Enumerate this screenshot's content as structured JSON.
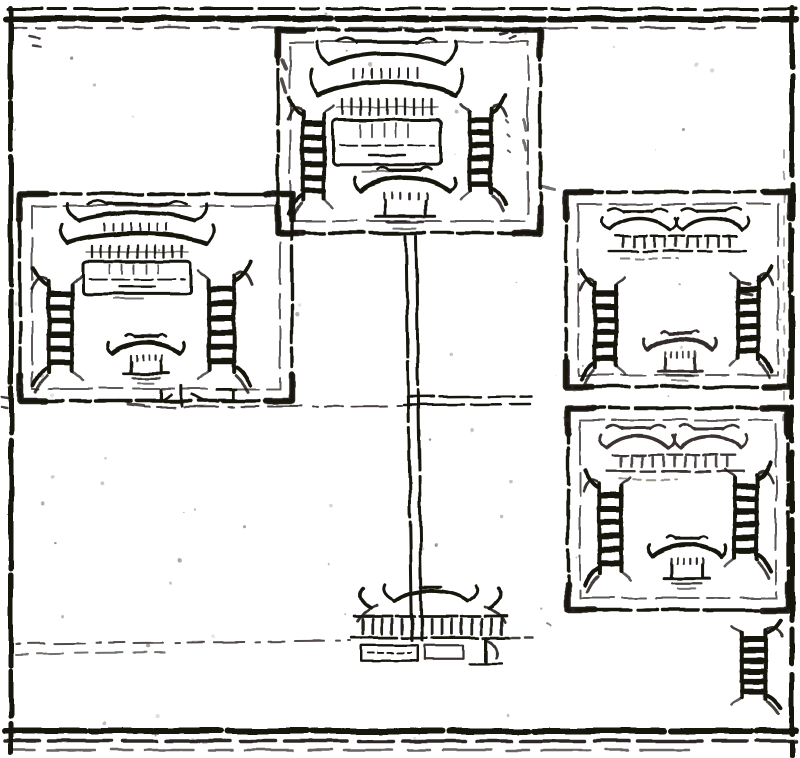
{
  "plate": {
    "alt": "woodblock plan of four walled temple compounds linked by an approach road to a main gate",
    "ink": "#17130e",
    "paper": "#ffffff",
    "compounds": [
      {
        "id": "north-central",
        "x": 278,
        "y": 30,
        "w": 262,
        "h": 203,
        "buildings": [
          {
            "type": "main-hall",
            "x": 312,
            "y": 36,
            "w": 150,
            "h": 140
          },
          {
            "type": "side-hall",
            "x": 286,
            "y": 100,
            "w": 56,
            "h": 112
          },
          {
            "type": "side-hall",
            "x": 452,
            "y": 98,
            "w": 56,
            "h": 106,
            "flip": true
          },
          {
            "type": "pavilion",
            "x": 352,
            "y": 160,
            "w": 106,
            "h": 74
          }
        ]
      },
      {
        "id": "west",
        "x": 20,
        "y": 194,
        "w": 272,
        "h": 207,
        "buildings": [
          {
            "type": "main-hall",
            "x": 62,
            "y": 200,
            "w": 150,
            "h": 102
          },
          {
            "type": "side-hall",
            "x": 30,
            "y": 270,
            "w": 62,
            "h": 114
          },
          {
            "type": "side-hall",
            "x": 188,
            "y": 264,
            "w": 66,
            "h": 120,
            "flip": true
          },
          {
            "type": "pavilion",
            "x": 106,
            "y": 328,
            "w": 80,
            "h": 60
          },
          {
            "type": "wall-gate",
            "x": 134,
            "y": 378,
            "w": 104,
            "h": 38
          }
        ]
      },
      {
        "id": "east-upper",
        "x": 566,
        "y": 192,
        "w": 224,
        "h": 195,
        "buildings": [
          {
            "type": "twin-hall",
            "x": 600,
            "y": 200,
            "w": 152,
            "h": 74
          },
          {
            "type": "side-hall",
            "x": 578,
            "y": 272,
            "w": 56,
            "h": 106
          },
          {
            "type": "side-hall",
            "x": 722,
            "y": 268,
            "w": 52,
            "h": 102,
            "flip": true
          },
          {
            "type": "pavilion",
            "x": 642,
            "y": 324,
            "w": 76,
            "h": 62,
            "op": 0.88
          }
        ]
      },
      {
        "id": "east-lower",
        "x": 568,
        "y": 408,
        "w": 220,
        "h": 202,
        "buildings": [
          {
            "type": "twin-hall",
            "x": 598,
            "y": 416,
            "w": 152,
            "h": 80,
            "op": 0.85
          },
          {
            "type": "side-hall",
            "x": 582,
            "y": 472,
            "w": 58,
            "h": 112
          },
          {
            "type": "side-hall",
            "x": 716,
            "y": 464,
            "w": 58,
            "h": 106,
            "flip": true
          },
          {
            "type": "pavilion",
            "x": 646,
            "y": 530,
            "w": 82,
            "h": 64
          }
        ]
      }
    ],
    "features": [
      {
        "type": "gate",
        "id": "main-gate",
        "x": 348,
        "y": 580,
        "w": 165,
        "h": 96
      },
      {
        "type": "side-hall",
        "id": "corner-shrine",
        "x": 722,
        "y": 622,
        "w": 62,
        "h": 86,
        "flip": true
      }
    ],
    "lines": [
      {
        "id": "border-top-outer",
        "x1": 8,
        "y1": 9,
        "x2": 796,
        "y2": 9,
        "w": 3,
        "dash": "34 6 18 9 52 7"
      },
      {
        "id": "border-top-main",
        "x1": 6,
        "y1": 19,
        "x2": 797,
        "y2": 19,
        "w": 6,
        "dash": "70 4 38 6 90 5"
      },
      {
        "id": "border-top-inner",
        "x1": 10,
        "y1": 28,
        "x2": 755,
        "y2": 28,
        "w": 2.2,
        "dash": "16 10 9 13 34 15",
        "op": 0.75
      },
      {
        "id": "border-left",
        "x1": 11,
        "y1": 8,
        "x2": 11,
        "y2": 753,
        "w": 5,
        "dash": "90 5 46 7 130 6"
      },
      {
        "id": "border-right",
        "x1": 792,
        "y1": 8,
        "x2": 792,
        "y2": 755,
        "w": 5,
        "dash": "60 8 100 9 34 11"
      },
      {
        "id": "border-right-ghost",
        "x1": 784,
        "y1": 150,
        "x2": 784,
        "y2": 420,
        "w": 1.6,
        "dash": "8 14",
        "op": 0.45
      },
      {
        "id": "border-bottom-main",
        "x1": 5,
        "y1": 731,
        "x2": 796,
        "y2": 731,
        "w": 6,
        "dash": "80 5 130 7"
      },
      {
        "id": "border-bottom-2",
        "x1": 5,
        "y1": 741,
        "x2": 796,
        "y2": 741,
        "w": 3.5,
        "dash": "34 9 64 11",
        "op": 0.9
      },
      {
        "id": "border-bottom-3",
        "x1": 12,
        "y1": 750,
        "x2": 700,
        "y2": 750,
        "w": 2.5,
        "dash": "22 13 48 16",
        "op": 0.65
      },
      {
        "id": "approach-road-west-edge",
        "x1": 406,
        "y1": 236,
        "x2": 412,
        "y2": 640,
        "w": 3,
        "dash": "120 5 60 6 90 5"
      },
      {
        "id": "approach-road-east-edge",
        "x1": 416,
        "y1": 236,
        "x2": 422,
        "y2": 640,
        "w": 3,
        "dash": "150 5 80 6"
      },
      {
        "id": "east-cross-road-top",
        "x1": 408,
        "y1": 397,
        "x2": 532,
        "y2": 396,
        "w": 2.5,
        "dash": "26 6 40 8"
      },
      {
        "id": "east-cross-road-bottom",
        "x1": 404,
        "y1": 405,
        "x2": 530,
        "y2": 404,
        "w": 2.5,
        "dash": "60 7 30 9"
      },
      {
        "id": "west-cross-road",
        "x1": 145,
        "y1": 407,
        "x2": 402,
        "y2": 406,
        "w": 2,
        "dash": "5 7 18 9 34 11",
        "op": 0.8
      },
      {
        "id": "forecourt-road-top",
        "x1": 16,
        "y1": 644,
        "x2": 350,
        "y2": 641,
        "w": 2,
        "dash": "4 8 16 10 30 12",
        "op": 0.75
      },
      {
        "id": "forecourt-road-bottom",
        "x1": 16,
        "y1": 654,
        "x2": 165,
        "y2": 652,
        "w": 2,
        "dash": "12 9 26 12",
        "op": 0.6
      },
      {
        "id": "gate-road-east-stub",
        "x1": 508,
        "y1": 638,
        "x2": 532,
        "y2": 638,
        "w": 2.5,
        "dash": "10 6",
        "op": 0.8
      }
    ],
    "marks": [
      {
        "d": "M500,34 l8,-2 m2,6 l6,-2",
        "w": 2.5,
        "op": 0.85
      },
      {
        "d": "M30,36 l10,2 m-6,8 l7,1",
        "w": 2.5,
        "op": 0.8
      },
      {
        "d": "M506,120 l2,2 m0,12 l2,2 m-2,14 l2,2",
        "w": 2.2,
        "op": 0.7
      },
      {
        "d": "M540,186 l14,3",
        "w": 3,
        "op": 0.6
      },
      {
        "d": "M128,404 l16,2",
        "w": 3,
        "op": 0.75
      },
      {
        "d": "M742,282 l8,2 m-10,8 l12,3",
        "w": 3,
        "op": 0.85
      },
      {
        "d": "M2,396 l6,1 m-6,10 l5,1",
        "w": 2.5,
        "op": 0.8
      },
      {
        "d": "M548,624 l3,2",
        "w": 2,
        "op": 0.5
      },
      {
        "d": "M282,60 l4,10 m-4,10 l4,12",
        "w": 3.5,
        "op": 0.75
      },
      {
        "d": "M524,120 l2,10 m-2,10 l2,10",
        "w": 3,
        "op": 0.6
      }
    ],
    "speckle": {
      "count": 70,
      "seed": 11
    }
  }
}
